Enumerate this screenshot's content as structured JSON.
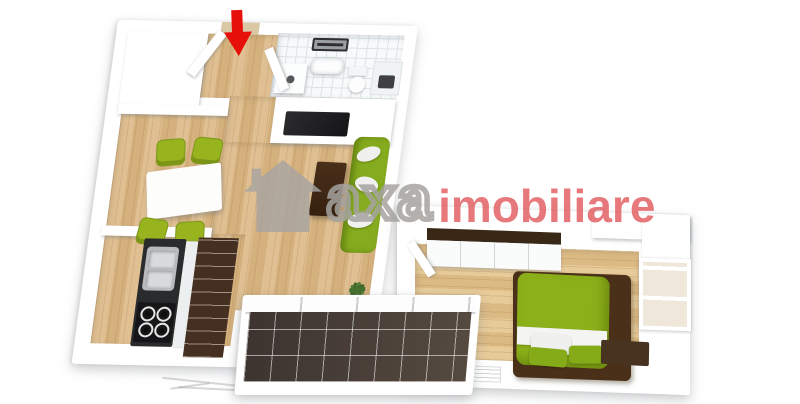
{
  "watermark": {
    "icon": "house-icon",
    "text_primary": "axa",
    "text_secondary": "imobiliare",
    "primary_color": "#a6a3a0",
    "secondary_color": "#e2585c"
  },
  "entrance_marker": {
    "shape": "down-arrow",
    "color": "#e60f0a"
  },
  "palette": {
    "background": "#ffffff",
    "walls": "#ffffff",
    "wall_shadow": "#c9ced2",
    "floor_living_wood": "#d9b98c",
    "floor_bedroom_wood": "#e2c48f",
    "bathroom_tile": "#f7f9fa",
    "balcony_tile": "#4a403a",
    "kitchen_backsplash_tile": "#452f21",
    "kitchen_counter": "#2a2b2d",
    "furniture_green": "#8fb01c",
    "dark_wood_furniture": "#46301d"
  },
  "scene": {
    "type": "3d-floor-plan-render",
    "rooms": [
      {
        "name": "entry-hall",
        "features": [
          "entrance-door-open",
          "down-arrow-marker"
        ]
      },
      {
        "name": "bathroom",
        "features": [
          "mirror",
          "washbasin",
          "toilet",
          "shower",
          "washing-machine"
        ]
      },
      {
        "name": "dining-area",
        "features": [
          "white-dining-table",
          "green-chair-x4"
        ]
      },
      {
        "name": "kitchen",
        "features": [
          "dark-countertop",
          "double-sink",
          "gas-hob",
          "brown-tiled-backsplash"
        ]
      },
      {
        "name": "living-room",
        "features": [
          "wall-mounted-tv",
          "green-sofa",
          "wood-coffee-table",
          "potted-plant"
        ]
      },
      {
        "name": "balcony",
        "features": [
          "dark-tile-floor",
          "glazed-window-front"
        ]
      },
      {
        "name": "bedroom",
        "features": [
          "green-double-bed",
          "sliding-wardrobe",
          "window",
          "dresser",
          "foot-bench",
          "radiator"
        ]
      }
    ]
  }
}
